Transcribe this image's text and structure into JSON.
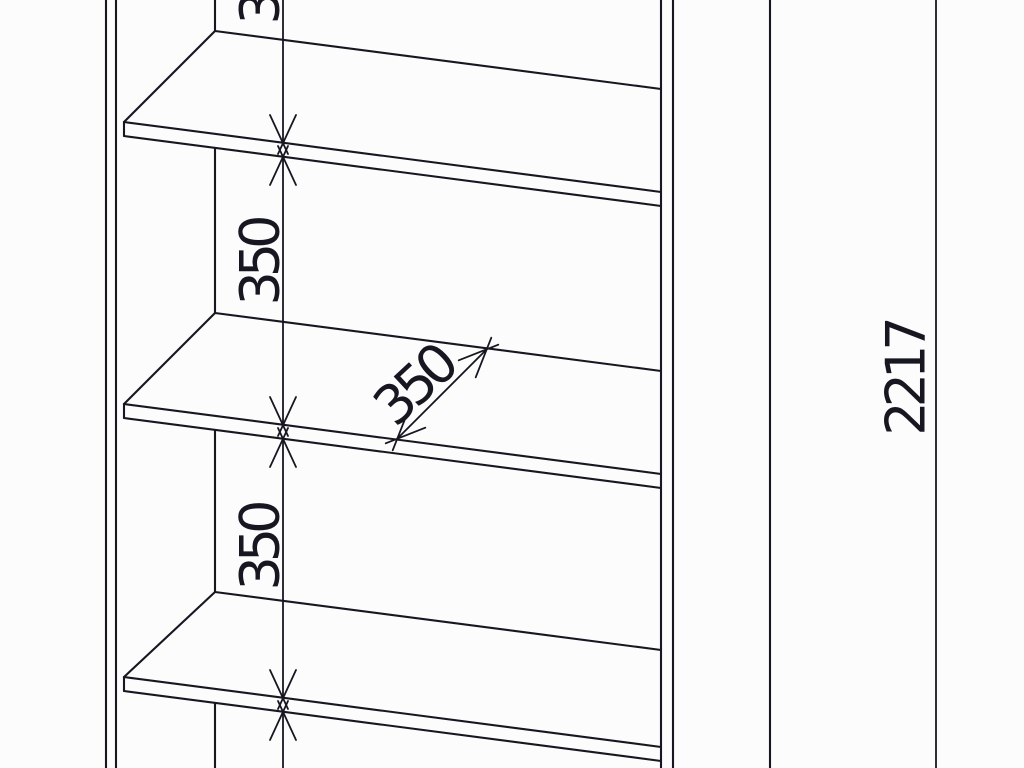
{
  "colors": {
    "background": "#fcfcfc",
    "line": "#171722"
  },
  "dimension_labels": {
    "shelf_gap_upper": "350",
    "shelf_gap_middle": "350",
    "shelf_gap_lower": "350",
    "shelf_depth": "350",
    "overall_height": "2217"
  }
}
